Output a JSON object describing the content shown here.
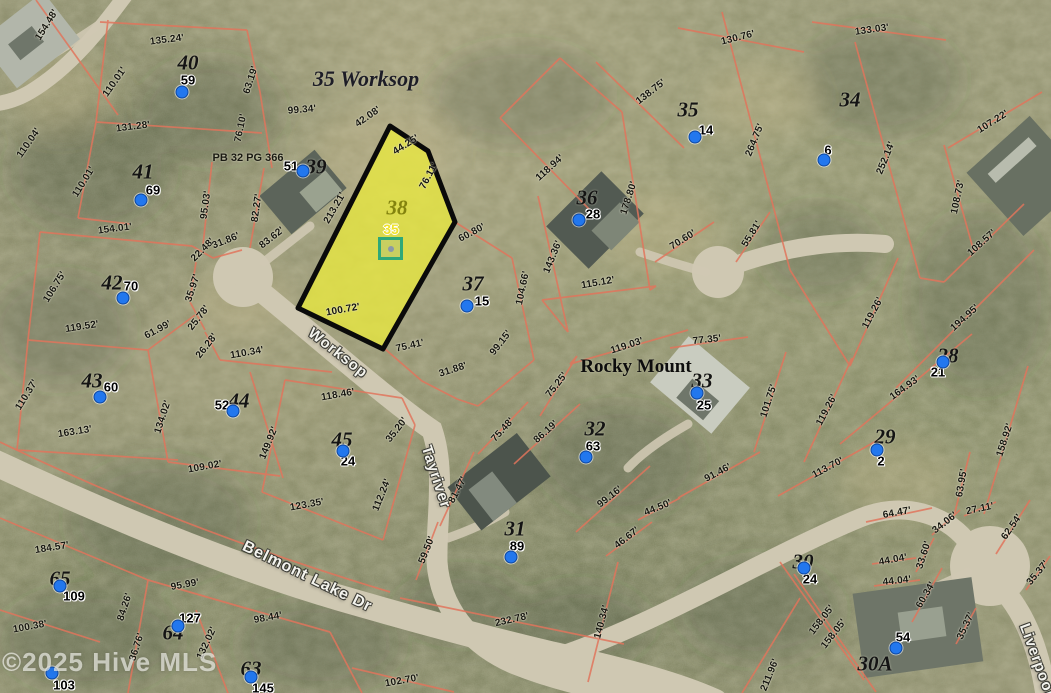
{
  "map": {
    "width": 1051,
    "height": 693,
    "title_label": "35 Worksop",
    "area_label": "Rocky Mount",
    "plat_ref": "PB 32 PG 366",
    "watermark": "©2025 Hive MLS",
    "subject": {
      "lot": "38",
      "marker_label": "35"
    },
    "streets": [
      {
        "name": "Worksop",
        "x": 338,
        "y": 353,
        "rot": 38,
        "size": 15
      },
      {
        "name": "Tayriver",
        "x": 436,
        "y": 477,
        "rot": 72,
        "size": 15
      },
      {
        "name": "Belmont Lake Dr",
        "x": 307,
        "y": 577,
        "rot": 26,
        "size": 16
      },
      {
        "name": "Liverpool",
        "x": 1037,
        "y": 660,
        "rot": 70,
        "size": 15
      }
    ],
    "lots": [
      {
        "label": "40",
        "x": 188,
        "y": 63,
        "pin": "59",
        "pin_x": 188,
        "pin_y": 80,
        "dot_x": 182,
        "dot_y": 92
      },
      {
        "label": "41",
        "x": 143,
        "y": 172,
        "pin": "69",
        "pin_x": 153,
        "pin_y": 190,
        "dot_x": 141,
        "dot_y": 200
      },
      {
        "label": "42",
        "x": 112,
        "y": 283,
        "pin": "70",
        "pin_x": 131,
        "pin_y": 286,
        "dot_x": 123,
        "dot_y": 298
      },
      {
        "label": "43",
        "x": 92,
        "y": 381,
        "pin": "60",
        "pin_x": 111,
        "pin_y": 387,
        "dot_x": 100,
        "dot_y": 397
      },
      {
        "label": "44",
        "x": 239,
        "y": 401,
        "pin": "52",
        "pin_x": 222,
        "pin_y": 405,
        "dot_x": 233,
        "dot_y": 411
      },
      {
        "label": "45",
        "x": 342,
        "y": 440,
        "pin": "24",
        "pin_x": 348,
        "pin_y": 461,
        "dot_x": 343,
        "dot_y": 451
      },
      {
        "label": "39",
        "x": 316,
        "y": 167,
        "pin": "51",
        "pin_x": 291,
        "pin_y": 166,
        "dot_x": 303,
        "dot_y": 171
      },
      {
        "label": "38",
        "x": 397,
        "y": 208,
        "pin": null,
        "pin_x": 0,
        "pin_y": 0,
        "dot_x": 0,
        "dot_y": 0
      },
      {
        "label": "37",
        "x": 473,
        "y": 284,
        "pin": "15",
        "pin_x": 482,
        "pin_y": 301,
        "dot_x": 467,
        "dot_y": 306
      },
      {
        "label": "36",
        "x": 587,
        "y": 198,
        "pin": "28",
        "pin_x": 593,
        "pin_y": 214,
        "dot_x": 579,
        "dot_y": 220
      },
      {
        "label": "35",
        "x": 688,
        "y": 110,
        "pin": "14",
        "pin_x": 706,
        "pin_y": 130,
        "dot_x": 695,
        "dot_y": 137
      },
      {
        "label": "34",
        "x": 850,
        "y": 100,
        "pin": "6",
        "pin_x": 828,
        "pin_y": 150,
        "dot_x": 824,
        "dot_y": 160
      },
      {
        "label": "33",
        "x": 702,
        "y": 381,
        "pin": "25",
        "pin_x": 704,
        "pin_y": 405,
        "dot_x": 697,
        "dot_y": 393
      },
      {
        "label": "32",
        "x": 595,
        "y": 429,
        "pin": "63",
        "pin_x": 593,
        "pin_y": 446,
        "dot_x": 586,
        "dot_y": 457
      },
      {
        "label": "31",
        "x": 515,
        "y": 529,
        "pin": "89",
        "pin_x": 517,
        "pin_y": 546,
        "dot_x": 511,
        "dot_y": 557
      },
      {
        "label": "30",
        "x": 803,
        "y": 562,
        "pin": "24",
        "pin_x": 810,
        "pin_y": 579,
        "dot_x": 804,
        "dot_y": 568
      },
      {
        "label": "30A",
        "x": 875,
        "y": 664,
        "pin": "54",
        "pin_x": 903,
        "pin_y": 637,
        "dot_x": 896,
        "dot_y": 648
      },
      {
        "label": "29",
        "x": 885,
        "y": 437,
        "pin": "2",
        "pin_x": 881,
        "pin_y": 461,
        "dot_x": 877,
        "dot_y": 450
      },
      {
        "label": "28",
        "x": 948,
        "y": 356,
        "pin": "21",
        "pin_x": 938,
        "pin_y": 372,
        "dot_x": 943,
        "dot_y": 362
      },
      {
        "label": "65",
        "x": 60,
        "y": 579,
        "pin": "109",
        "pin_x": 74,
        "pin_y": 596,
        "dot_x": 60,
        "dot_y": 586
      },
      {
        "label": "64",
        "x": 173,
        "y": 633,
        "pin": "127",
        "pin_x": 190,
        "pin_y": 618,
        "dot_x": 178,
        "dot_y": 626
      },
      {
        "label": "63",
        "x": 251,
        "y": 669,
        "pin": "145",
        "pin_x": 263,
        "pin_y": 688,
        "dot_x": 251,
        "dot_y": 677
      }
    ],
    "extra_pins": [
      {
        "num": "103",
        "x": 64,
        "y": 685,
        "dot_x": 52,
        "dot_y": 673
      }
    ],
    "dimensions": [
      {
        "t": "154.48'",
        "x": 47,
        "y": 25,
        "r": -58
      },
      {
        "t": "135.24'",
        "x": 167,
        "y": 40,
        "r": -7
      },
      {
        "t": "110.01'",
        "x": 115,
        "y": 82,
        "r": -55
      },
      {
        "t": "63.19'",
        "x": 251,
        "y": 80,
        "r": -72
      },
      {
        "t": "131.28'",
        "x": 133,
        "y": 127,
        "r": -7
      },
      {
        "t": "76.10'",
        "x": 241,
        "y": 128,
        "r": -78
      },
      {
        "t": "99.34'",
        "x": 302,
        "y": 110,
        "r": -5
      },
      {
        "t": "110.04'",
        "x": 29,
        "y": 143,
        "r": -55
      },
      {
        "t": "110.01'",
        "x": 84,
        "y": 182,
        "r": -58
      },
      {
        "t": "95.03'",
        "x": 206,
        "y": 205,
        "r": -82
      },
      {
        "t": "82.27'",
        "x": 257,
        "y": 208,
        "r": -82
      },
      {
        "t": "42.08'",
        "x": 368,
        "y": 117,
        "r": -35
      },
      {
        "t": "44.25'",
        "x": 406,
        "y": 145,
        "r": -32
      },
      {
        "t": "76.11'",
        "x": 429,
        "y": 176,
        "r": -62
      },
      {
        "t": "213.21'",
        "x": 335,
        "y": 208,
        "r": -60
      },
      {
        "t": "154.01'",
        "x": 115,
        "y": 229,
        "r": -7
      },
      {
        "t": "106.75'",
        "x": 55,
        "y": 287,
        "r": -58
      },
      {
        "t": "119.52'",
        "x": 82,
        "y": 327,
        "r": -9
      },
      {
        "t": "61.99'",
        "x": 158,
        "y": 330,
        "r": -28
      },
      {
        "t": "22.48'",
        "x": 203,
        "y": 250,
        "r": -45
      },
      {
        "t": "31.86'",
        "x": 226,
        "y": 241,
        "r": -22
      },
      {
        "t": "35.97'",
        "x": 193,
        "y": 288,
        "r": -72
      },
      {
        "t": "25.78'",
        "x": 199,
        "y": 318,
        "r": -52
      },
      {
        "t": "26.28'",
        "x": 207,
        "y": 346,
        "r": -52
      },
      {
        "t": "110.34'",
        "x": 247,
        "y": 353,
        "r": -10
      },
      {
        "t": "83.62'",
        "x": 272,
        "y": 238,
        "r": -38
      },
      {
        "t": "110.37'",
        "x": 27,
        "y": 395,
        "r": -58
      },
      {
        "t": "163.13'",
        "x": 75,
        "y": 432,
        "r": -9
      },
      {
        "t": "134.02'",
        "x": 163,
        "y": 417,
        "r": -72
      },
      {
        "t": "109.02'",
        "x": 205,
        "y": 467,
        "r": -10
      },
      {
        "t": "149.92'",
        "x": 269,
        "y": 443,
        "r": -68
      },
      {
        "t": "118.46'",
        "x": 338,
        "y": 395,
        "r": -10
      },
      {
        "t": "123.35'",
        "x": 307,
        "y": 505,
        "r": -10
      },
      {
        "t": "112.24'",
        "x": 382,
        "y": 495,
        "r": -68
      },
      {
        "t": "35.20'",
        "x": 397,
        "y": 430,
        "r": -52
      },
      {
        "t": "75.48'",
        "x": 503,
        "y": 430,
        "r": -48
      },
      {
        "t": "184.57'",
        "x": 52,
        "y": 548,
        "r": -9
      },
      {
        "t": "100.38'",
        "x": 30,
        "y": 627,
        "r": -10
      },
      {
        "t": "95.99'",
        "x": 185,
        "y": 585,
        "r": -10
      },
      {
        "t": "84.26'",
        "x": 125,
        "y": 607,
        "r": -72
      },
      {
        "t": "86.76'",
        "x": 137,
        "y": 647,
        "r": -72
      },
      {
        "t": "132.02'",
        "x": 207,
        "y": 643,
        "r": -65
      },
      {
        "t": "98.44'",
        "x": 268,
        "y": 618,
        "r": -10
      },
      {
        "t": "102.70'",
        "x": 402,
        "y": 681,
        "r": -10
      },
      {
        "t": "59.50'",
        "x": 427,
        "y": 550,
        "r": -68
      },
      {
        "t": "81.47'",
        "x": 458,
        "y": 490,
        "r": -62
      },
      {
        "t": "232.78'",
        "x": 512,
        "y": 620,
        "r": -13
      },
      {
        "t": "140.34'",
        "x": 602,
        "y": 622,
        "r": -75
      },
      {
        "t": "46.67'",
        "x": 627,
        "y": 538,
        "r": -38
      },
      {
        "t": "99.16'",
        "x": 610,
        "y": 497,
        "r": -38
      },
      {
        "t": "86.19'",
        "x": 546,
        "y": 432,
        "r": -42
      },
      {
        "t": "44.50'",
        "x": 658,
        "y": 508,
        "r": -22
      },
      {
        "t": "91.46'",
        "x": 718,
        "y": 473,
        "r": -28
      },
      {
        "t": "75.25'",
        "x": 557,
        "y": 385,
        "r": -52
      },
      {
        "t": "119.03'",
        "x": 627,
        "y": 346,
        "r": -18
      },
      {
        "t": "77.35'",
        "x": 707,
        "y": 340,
        "r": -6
      },
      {
        "t": "101.75'",
        "x": 769,
        "y": 401,
        "r": -72
      },
      {
        "t": "27.11'",
        "x": 980,
        "y": 509,
        "r": -12
      },
      {
        "t": "60.80'",
        "x": 472,
        "y": 233,
        "r": -28
      },
      {
        "t": "104.66'",
        "x": 523,
        "y": 288,
        "r": -78
      },
      {
        "t": "100.72'",
        "x": 343,
        "y": 310,
        "r": -10
      },
      {
        "t": "75.41'",
        "x": 410,
        "y": 346,
        "r": -13
      },
      {
        "t": "31.88'",
        "x": 453,
        "y": 370,
        "r": -18
      },
      {
        "t": "99.15'",
        "x": 501,
        "y": 343,
        "r": -52
      },
      {
        "t": "118.94'",
        "x": 550,
        "y": 168,
        "r": -42
      },
      {
        "t": "178.80'",
        "x": 629,
        "y": 198,
        "r": -72
      },
      {
        "t": "143.36'",
        "x": 553,
        "y": 257,
        "r": -68
      },
      {
        "t": "115.12'",
        "x": 598,
        "y": 283,
        "r": -10
      },
      {
        "t": "70.60'",
        "x": 683,
        "y": 240,
        "r": -32
      },
      {
        "t": "55.81'",
        "x": 752,
        "y": 234,
        "r": -58
      },
      {
        "t": "138.75'",
        "x": 651,
        "y": 92,
        "r": -38
      },
      {
        "t": "264.75'",
        "x": 755,
        "y": 140,
        "r": -68
      },
      {
        "t": "130.76'",
        "x": 738,
        "y": 38,
        "r": -14
      },
      {
        "t": "133.03'",
        "x": 872,
        "y": 30,
        "r": -8
      },
      {
        "t": "107.22'",
        "x": 993,
        "y": 122,
        "r": -32
      },
      {
        "t": "252.14'",
        "x": 886,
        "y": 158,
        "r": -68
      },
      {
        "t": "108.73'",
        "x": 958,
        "y": 197,
        "r": -78
      },
      {
        "t": "108.57'",
        "x": 982,
        "y": 243,
        "r": -42
      },
      {
        "t": "194.95'",
        "x": 965,
        "y": 318,
        "r": -42
      },
      {
        "t": "119.26'",
        "x": 873,
        "y": 313,
        "r": -62
      },
      {
        "t": "119.26'",
        "x": 827,
        "y": 410,
        "r": -62
      },
      {
        "t": "164.93'",
        "x": 905,
        "y": 388,
        "r": -36
      },
      {
        "t": "113.70'",
        "x": 828,
        "y": 468,
        "r": -28
      },
      {
        "t": "158.92'",
        "x": 1005,
        "y": 440,
        "r": -72
      },
      {
        "t": "63.95'",
        "x": 962,
        "y": 483,
        "r": -80
      },
      {
        "t": "64.47'",
        "x": 897,
        "y": 513,
        "r": -10
      },
      {
        "t": "34.06'",
        "x": 945,
        "y": 523,
        "r": -38
      },
      {
        "t": "62.54'",
        "x": 1012,
        "y": 527,
        "r": -55
      },
      {
        "t": "33.60'",
        "x": 924,
        "y": 555,
        "r": -72
      },
      {
        "t": "44.04'",
        "x": 893,
        "y": 560,
        "r": -10
      },
      {
        "t": "44.04'",
        "x": 897,
        "y": 581,
        "r": -6
      },
      {
        "t": "60.34'",
        "x": 926,
        "y": 595,
        "r": -60
      },
      {
        "t": "35.37'",
        "x": 1038,
        "y": 573,
        "r": -50
      },
      {
        "t": "35.37'",
        "x": 966,
        "y": 626,
        "r": -65
      },
      {
        "t": "158.05'",
        "x": 822,
        "y": 620,
        "r": -52
      },
      {
        "t": "158.05'",
        "x": 834,
        "y": 634,
        "r": -52
      },
      {
        "t": "211.96'",
        "x": 770,
        "y": 675,
        "r": -68
      }
    ],
    "colors": {
      "parcel_line": "#e0745c",
      "subject_fill": "#e9e93f",
      "subject_outline": "#000000",
      "subject_label": "#83830e",
      "marker_teal": "#2fa878",
      "marker_number": "#f0e32a",
      "pin_dot": "#2277ee",
      "road": "#cfc8b2",
      "terrain_base": "#93906f"
    }
  }
}
